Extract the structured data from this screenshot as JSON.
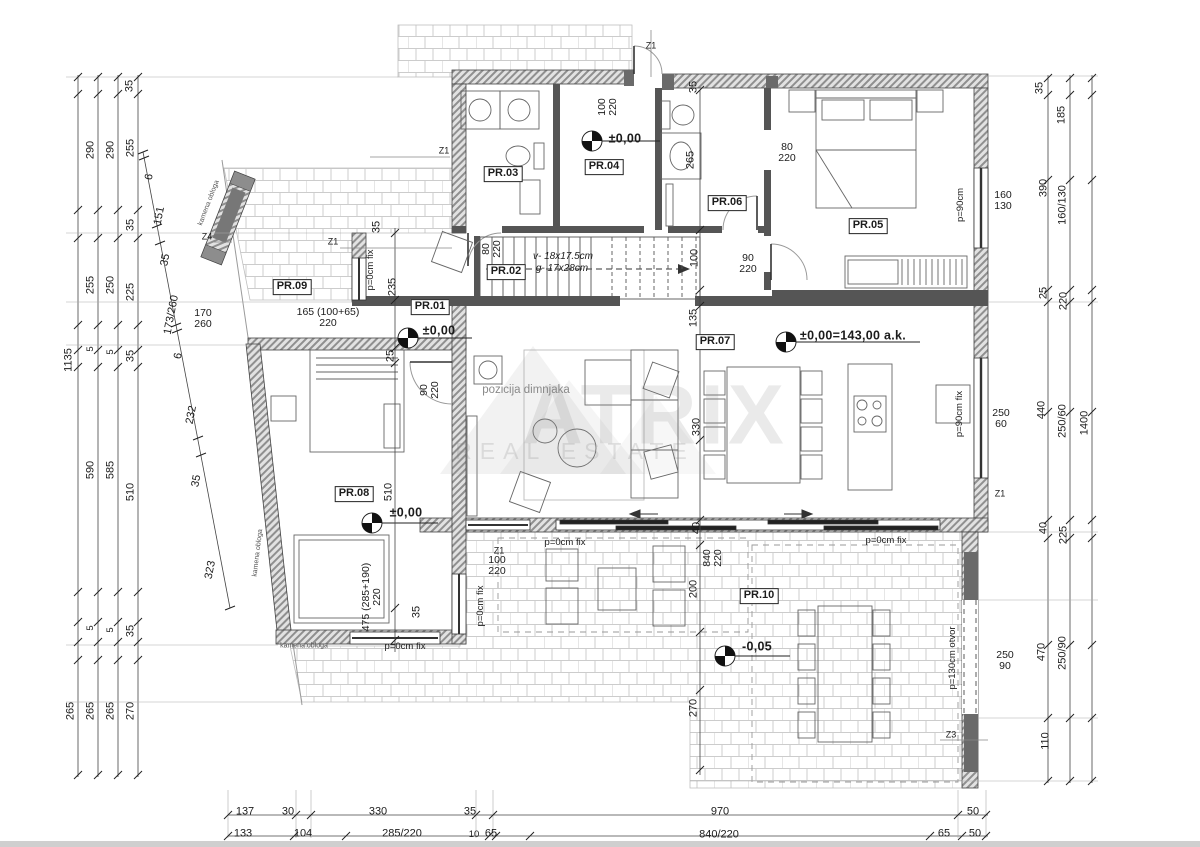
{
  "colors": {
    "paper": "#ffffff",
    "line": "#3c3c3c",
    "brick_hatch": "#cccccc",
    "wall_hatch": "#8f8f8f",
    "wall_dark": "#555555",
    "watermark": "#7d7d7d",
    "bottom_strip": "#cfcfcf"
  },
  "watermark": {
    "line1": "ATRIX",
    "line2": "REAL ESTATE"
  },
  "plan": {
    "labels": [
      {
        "n": "room-label-pr01",
        "t": "PR.01",
        "x": 430,
        "y": 307,
        "c": "room"
      },
      {
        "n": "room-label-pr02",
        "t": "PR.02",
        "x": 506,
        "y": 272,
        "c": "room"
      },
      {
        "n": "room-label-pr03",
        "t": "PR.03",
        "x": 503,
        "y": 174,
        "c": "room"
      },
      {
        "n": "room-label-pr04",
        "t": "PR.04",
        "x": 604,
        "y": 167,
        "c": "room"
      },
      {
        "n": "room-label-pr05",
        "t": "PR.05",
        "x": 868,
        "y": 226,
        "c": "room"
      },
      {
        "n": "room-label-pr06",
        "t": "PR.06",
        "x": 727,
        "y": 203,
        "c": "room"
      },
      {
        "n": "room-label-pr07",
        "t": "PR.07",
        "x": 715,
        "y": 342,
        "c": "room"
      },
      {
        "n": "room-label-pr08",
        "t": "PR.08",
        "x": 354,
        "y": 494,
        "c": "room"
      },
      {
        "n": "room-label-pr09",
        "t": "PR.09",
        "x": 292,
        "y": 287,
        "c": "room"
      },
      {
        "n": "room-label-pr10",
        "t": "PR.10",
        "x": 759,
        "y": 596,
        "c": "room"
      },
      {
        "n": "elevation-pr04",
        "t": "±0,00",
        "x": 625,
        "y": 139,
        "c": "elev"
      },
      {
        "n": "elevation-pr01",
        "t": "±0,00",
        "x": 439,
        "y": 331,
        "c": "elev"
      },
      {
        "n": "elevation-pr08",
        "t": "±0,00",
        "x": 406,
        "y": 513,
        "c": "elev"
      },
      {
        "n": "elevation-pr07",
        "t": "±0,00=143,00  a.k.",
        "x": 853,
        "y": 336,
        "c": "elev"
      },
      {
        "n": "elevation-pr10",
        "t": "-0,05",
        "x": 757,
        "y": 647,
        "c": "elev"
      },
      {
        "n": "stairs-riser-note",
        "t": "v- 18x17.5cm",
        "x": 563,
        "y": 257,
        "c": "stair"
      },
      {
        "n": "stairs-going-note",
        "t": "g- 17x28cm",
        "x": 562,
        "y": 269,
        "c": "stair"
      },
      {
        "n": "chimney-note",
        "t": "pozicija dimnjaka",
        "x": 526,
        "y": 391,
        "c": "note"
      },
      {
        "n": "stone-cladding-note-1",
        "t": "kamena obloga",
        "x": 209,
        "y": 203,
        "r": -69,
        "c": "tiny"
      },
      {
        "n": "stone-cladding-note-2",
        "t": "kamena obloga",
        "x": 258,
        "y": 553,
        "r": -83,
        "c": "tiny"
      },
      {
        "n": "stone-cladding-note-3",
        "t": "kamena obloga",
        "x": 304,
        "y": 646,
        "c": "tiny"
      },
      {
        "n": "window-note-west",
        "t": "p=0cm fix",
        "x": 371,
        "y": 270,
        "r": -90,
        "c": "dims"
      },
      {
        "n": "window-note-pr08-east",
        "t": "p=0cm fix",
        "x": 481,
        "y": 606,
        "r": -90,
        "c": "dims"
      },
      {
        "n": "window-note-south-1",
        "t": "p=0cm fix",
        "x": 565,
        "y": 543,
        "c": "dims"
      },
      {
        "n": "window-note-south-2",
        "t": "p=0cm fix",
        "x": 886,
        "y": 541,
        "c": "dims"
      },
      {
        "n": "window-note-pr08-south",
        "t": "p=0cm fix",
        "x": 405,
        "y": 647,
        "c": "dims"
      },
      {
        "n": "window-note-pr05",
        "t": "p=90cm",
        "x": 961,
        "y": 205,
        "r": -90,
        "c": "dims"
      },
      {
        "n": "window-note-pr07",
        "t": "p=90cm fix",
        "x": 960,
        "y": 414,
        "r": -90,
        "c": "dims"
      },
      {
        "n": "opening-note-terrace",
        "t": "p=130cm otvor",
        "x": 953,
        "y": 658,
        "r": -90,
        "c": "dims"
      },
      {
        "n": "dim-entry-door",
        "t": "100\n220",
        "x": 608,
        "y": 107,
        "r": -90,
        "c": "frac"
      },
      {
        "n": "dim-pr05-door",
        "t": "80\n220",
        "x": 787,
        "y": 153,
        "c": "frac"
      },
      {
        "n": "dim-pr02-door",
        "t": "80\n220",
        "x": 492,
        "y": 249,
        "r": -90,
        "c": "frac"
      },
      {
        "n": "dim-corridor-door",
        "t": "90\n220",
        "x": 748,
        "y": 264,
        "c": "frac"
      },
      {
        "n": "dim-pr08-door",
        "t": "90\n220",
        "x": 430,
        "y": 390,
        "r": -90,
        "c": "frac"
      },
      {
        "n": "dim-sliding-opening",
        "t": "840\n220",
        "x": 713,
        "y": 558,
        "r": -90,
        "c": "frac"
      },
      {
        "n": "dim-pr10-window",
        "t": "100\n220",
        "x": 497,
        "y": 566,
        "c": "frac"
      },
      {
        "n": "dim-pr09-opening",
        "t": "165 (100+65)\n220",
        "x": 328,
        "y": 318,
        "c": "frac"
      },
      {
        "n": "dim-stone-opening",
        "t": "170\n260",
        "x": 203,
        "y": 319,
        "c": "frac"
      },
      {
        "n": "dim-pr05-window",
        "t": "160\n130",
        "x": 1003,
        "y": 201,
        "c": "frac"
      },
      {
        "n": "dim-pr07-window",
        "t": "250\n60",
        "x": 1001,
        "y": 419,
        "c": "frac"
      },
      {
        "n": "dim-terrace-window",
        "t": "250\n90",
        "x": 1005,
        "y": 661,
        "c": "frac"
      },
      {
        "n": "dim-pr08-window",
        "t": "475 (285+190)\n220",
        "x": 372,
        "y": 597,
        "r": -90,
        "c": "frac"
      },
      {
        "n": "dim-interior-100",
        "t": "100",
        "x": 695,
        "y": 258,
        "r": -90
      },
      {
        "n": "dim-interior-265",
        "t": "265",
        "x": 691,
        "y": 160,
        "r": -90
      },
      {
        "n": "dim-interior-135",
        "t": "135",
        "x": 694,
        "y": 318,
        "r": -90
      },
      {
        "n": "dim-interior-330",
        "t": "330",
        "x": 697,
        "y": 427,
        "r": -90
      },
      {
        "n": "dim-interior-40",
        "t": "40",
        "x": 697,
        "y": 528,
        "r": -90
      },
      {
        "n": "dim-interior-200",
        "t": "200",
        "x": 694,
        "y": 589,
        "r": -90
      },
      {
        "n": "dim-interior-270",
        "t": "270",
        "x": 694,
        "y": 708,
        "r": -90
      },
      {
        "n": "dim-interior-25",
        "t": "25",
        "x": 391,
        "y": 356,
        "r": -90
      },
      {
        "n": "dim-interior-235",
        "t": "235",
        "x": 393,
        "y": 287,
        "r": -90
      },
      {
        "n": "dim-interior-35a",
        "t": "35",
        "x": 377,
        "y": 227,
        "r": -90
      },
      {
        "n": "dim-interior-510",
        "t": "510",
        "x": 389,
        "y": 492,
        "r": -90
      },
      {
        "n": "dim-interior-35b",
        "t": "35",
        "x": 417,
        "y": 612,
        "r": -90
      },
      {
        "n": "dim-interior-35top",
        "t": "35",
        "x": 694,
        "y": 87,
        "r": -90
      },
      {
        "n": "section-mark-z1-top",
        "t": "Z1",
        "x": 651,
        "y": 46,
        "c": "zmark"
      },
      {
        "n": "section-mark-z1-pr03",
        "t": "Z1",
        "x": 444,
        "y": 151,
        "c": "zmark"
      },
      {
        "n": "section-mark-z1-west",
        "t": "Z1",
        "x": 333,
        "y": 242,
        "c": "zmark"
      },
      {
        "n": "section-mark-z1-south",
        "t": "Z1",
        "x": 499,
        "y": 551,
        "c": "zmark"
      },
      {
        "n": "section-mark-z1-east",
        "t": "Z1",
        "x": 1000,
        "y": 494,
        "c": "zmark"
      },
      {
        "n": "section-mark-z3",
        "t": "Z3",
        "x": 951,
        "y": 735,
        "c": "zmark"
      },
      {
        "n": "section-mark-z4",
        "t": "Z4",
        "x": 207,
        "y": 237,
        "c": "zmark"
      },
      {
        "n": "dim-left-1135",
        "t": "1135",
        "x": 69,
        "y": 360,
        "r": -90
      },
      {
        "n": "dim-left-265a",
        "t": "265",
        "x": 71,
        "y": 711,
        "r": -90
      },
      {
        "n": "dim-left-290a",
        "t": "290",
        "x": 91,
        "y": 150,
        "r": -90
      },
      {
        "n": "dim-left-255a",
        "t": "255",
        "x": 91,
        "y": 285,
        "r": -90
      },
      {
        "n": "dim-left-5a",
        "t": "5",
        "x": 91,
        "y": 349,
        "r": -90,
        "c": "dims"
      },
      {
        "n": "dim-left-590",
        "t": "590",
        "x": 91,
        "y": 470,
        "r": -90
      },
      {
        "n": "dim-left-5b",
        "t": "5",
        "x": 91,
        "y": 628,
        "r": -90,
        "c": "dims"
      },
      {
        "n": "dim-left-265b",
        "t": "265",
        "x": 91,
        "y": 711,
        "r": -90
      },
      {
        "n": "dim-left-290b",
        "t": "290",
        "x": 111,
        "y": 150,
        "r": -90
      },
      {
        "n": "dim-left-250",
        "t": "250",
        "x": 111,
        "y": 285,
        "r": -90
      },
      {
        "n": "dim-left-5c",
        "t": "5",
        "x": 111,
        "y": 352,
        "r": -90,
        "c": "dims"
      },
      {
        "n": "dim-left-585",
        "t": "585",
        "x": 111,
        "y": 470,
        "r": -90
      },
      {
        "n": "dim-left-5d",
        "t": "5",
        "x": 111,
        "y": 630,
        "r": -90,
        "c": "dims"
      },
      {
        "n": "dim-left-265c",
        "t": "265",
        "x": 111,
        "y": 711,
        "r": -90
      },
      {
        "n": "dim-left-35a",
        "t": "35",
        "x": 130,
        "y": 86,
        "r": -90
      },
      {
        "n": "dim-left-255b",
        "t": "255",
        "x": 131,
        "y": 148,
        "r": -90
      },
      {
        "n": "dim-left-35b",
        "t": "35",
        "x": 131,
        "y": 225,
        "r": -90
      },
      {
        "n": "dim-left-225",
        "t": "225",
        "x": 131,
        "y": 292,
        "r": -90
      },
      {
        "n": "dim-left-35c",
        "t": "35",
        "x": 131,
        "y": 356,
        "r": -90
      },
      {
        "n": "dim-left-510",
        "t": "510",
        "x": 131,
        "y": 492,
        "r": -90
      },
      {
        "n": "dim-left-35d",
        "t": "35",
        "x": 131,
        "y": 631,
        "r": -90
      },
      {
        "n": "dim-left-270",
        "t": "270",
        "x": 131,
        "y": 711,
        "r": -90
      },
      {
        "n": "dim-diag-6a",
        "t": "6",
        "x": 150,
        "y": 177,
        "r": -79
      },
      {
        "n": "dim-diag-151",
        "t": "151",
        "x": 160,
        "y": 216,
        "r": -79
      },
      {
        "n": "dim-diag-35a",
        "t": "35",
        "x": 166,
        "y": 260,
        "r": -79
      },
      {
        "n": "dim-diag-173-260",
        "t": "173/260",
        "x": 172,
        "y": 315,
        "r": -79
      },
      {
        "n": "dim-diag-6b",
        "t": "6",
        "x": 179,
        "y": 356,
        "r": -79
      },
      {
        "n": "dim-diag-232",
        "t": "232",
        "x": 192,
        "y": 415,
        "r": -79
      },
      {
        "n": "dim-diag-35b",
        "t": "35",
        "x": 197,
        "y": 481,
        "r": -79
      },
      {
        "n": "dim-diag-323",
        "t": "323",
        "x": 211,
        "y": 570,
        "r": -79
      },
      {
        "n": "dim-right-35",
        "t": "35",
        "x": 1040,
        "y": 88,
        "r": -90
      },
      {
        "n": "dim-right-185",
        "t": "185",
        "x": 1062,
        "y": 115,
        "r": -90
      },
      {
        "n": "dim-right-390",
        "t": "390",
        "x": 1044,
        "y": 188,
        "r": -90
      },
      {
        "n": "dim-right-160-130",
        "t": "160/130",
        "x": 1063,
        "y": 205,
        "r": -90
      },
      {
        "n": "dim-right-25",
        "t": "25",
        "x": 1044,
        "y": 293,
        "r": -90
      },
      {
        "n": "dim-right-220",
        "t": "220",
        "x": 1064,
        "y": 301,
        "r": -90
      },
      {
        "n": "dim-right-440",
        "t": "440",
        "x": 1042,
        "y": 410,
        "r": -90
      },
      {
        "n": "dim-right-250-60",
        "t": "250/60",
        "x": 1063,
        "y": 421,
        "r": -90
      },
      {
        "n": "dim-right-40",
        "t": "40",
        "x": 1044,
        "y": 528,
        "r": -90
      },
      {
        "n": "dim-right-225",
        "t": "225",
        "x": 1064,
        "y": 535,
        "r": -90
      },
      {
        "n": "dim-right-470",
        "t": "470",
        "x": 1042,
        "y": 652,
        "r": -90
      },
      {
        "n": "dim-right-250-90",
        "t": "250/90",
        "x": 1063,
        "y": 653,
        "r": -90
      },
      {
        "n": "dim-right-110",
        "t": "110",
        "x": 1046,
        "y": 741,
        "r": -90
      },
      {
        "n": "dim-right-1400",
        "t": "1400",
        "x": 1085,
        "y": 423,
        "r": -90
      },
      {
        "n": "dim-bottom-137",
        "t": "137",
        "x": 245,
        "y": 812
      },
      {
        "n": "dim-bottom-30",
        "t": "30",
        "x": 288,
        "y": 812
      },
      {
        "n": "dim-bottom-330",
        "t": "330",
        "x": 378,
        "y": 812
      },
      {
        "n": "dim-bottom-35",
        "t": "35",
        "x": 470,
        "y": 812
      },
      {
        "n": "dim-bottom-970",
        "t": "970",
        "x": 720,
        "y": 812
      },
      {
        "n": "dim-bottom-50a",
        "t": "50",
        "x": 973,
        "y": 812
      },
      {
        "n": "dim-bottom-133",
        "t": "133",
        "x": 243,
        "y": 834
      },
      {
        "n": "dim-bottom-104",
        "t": "104",
        "x": 303,
        "y": 834
      },
      {
        "n": "dim-bottom-285-220",
        "t": "285/220",
        "x": 402,
        "y": 834
      },
      {
        "n": "dim-bottom-10",
        "t": "10",
        "x": 474,
        "y": 835,
        "c": "dims"
      },
      {
        "n": "dim-bottom-65a",
        "t": "65",
        "x": 491,
        "y": 834
      },
      {
        "n": "dim-bottom-840-220",
        "t": "840/220",
        "x": 719,
        "y": 835
      },
      {
        "n": "dim-bottom-65b",
        "t": "65",
        "x": 944,
        "y": 834
      },
      {
        "n": "dim-bottom-50b",
        "t": "50",
        "x": 975,
        "y": 834
      },
      {
        "n": "watermark-title",
        "t": "ATRIX",
        "x": 655,
        "y": 415,
        "c": "wm1"
      },
      {
        "n": "watermark-subtitle",
        "t": "REAL ESTATE",
        "x": 575,
        "y": 452,
        "c": "wm2"
      }
    ]
  }
}
